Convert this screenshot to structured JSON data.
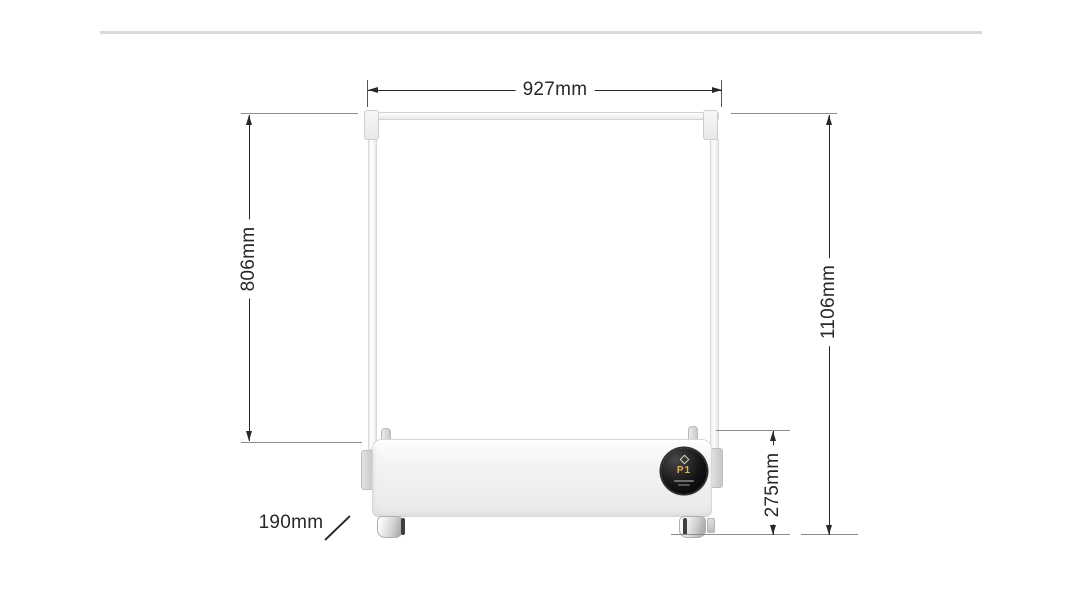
{
  "page": {
    "background": "#ffffff",
    "divider_color": "#dadada"
  },
  "product": {
    "display": {
      "mode": "P1",
      "mode_color": "#e3b04b"
    }
  },
  "dimensions": {
    "line_color": "#2b2728",
    "top_width": {
      "label": "927mm"
    },
    "left_height": {
      "label": "806mm"
    },
    "total_height": {
      "label": "1106mm"
    },
    "base_height": {
      "label": "275mm"
    },
    "depth": {
      "label": "190mm"
    }
  }
}
